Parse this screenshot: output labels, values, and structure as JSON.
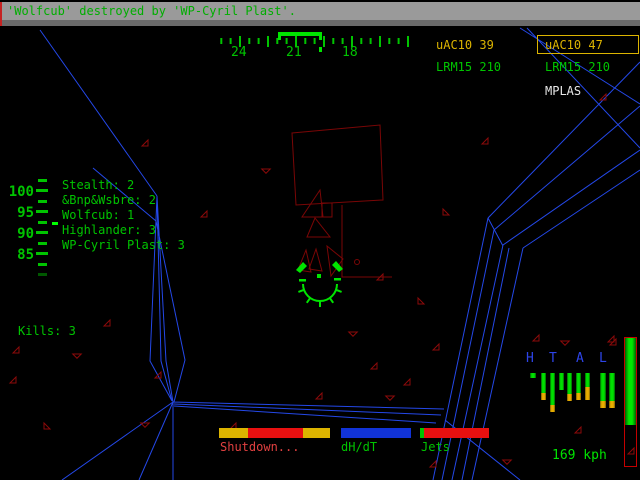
{
  "colors": {
    "hud_green": "#00c400",
    "bright_green": "#00e400",
    "hud_yellow": "#dcb400",
    "hud_red": "#e81010",
    "red_text": "#e04040",
    "hud_blue_bar": "#1133d8",
    "cockpit_blue": "#2448e8",
    "letter_blue": "#2d44e8",
    "wireframe_maroon": "#7a0606",
    "message_bar_gray": "#9a9a9a",
    "white": "#e8e8e8"
  },
  "message_bar": {
    "text": "'Wolfcub' destroyed by 'WP-Cyril Plast'."
  },
  "compass": {
    "labels": [
      "24",
      "21",
      "18"
    ]
  },
  "weapons": {
    "left": [
      {
        "label": "uAC10 39"
      },
      {
        "label": "LRM15 210"
      }
    ],
    "right": [
      {
        "label": "uAC10 47",
        "selected": true
      },
      {
        "label": "LRM15 210"
      },
      {
        "label": "MPLAS"
      }
    ]
  },
  "throttle_scale": {
    "labels": [
      "100",
      "95",
      "90",
      "85"
    ]
  },
  "scoreboard": [
    "Stealth: 2",
    "&Bnp&Wsbre: 2",
    "Wolfcub: 1",
    "Highlander: 3",
    "WP-Cyril Plast: 3"
  ],
  "kills": "Kills: 3",
  "bottom": {
    "shutdown": "Shutdown...",
    "dhdt": "dH/dT",
    "jets": "Jets"
  },
  "speed": "169 kph",
  "damage_panel": {
    "letters": [
      "H",
      "T",
      "A",
      "L"
    ],
    "bars": [
      {
        "x": 530,
        "w": 6,
        "green": 5,
        "yellow": 0
      },
      {
        "x": 541,
        "w": 5,
        "green": 20,
        "yellow": 7
      },
      {
        "x": 550,
        "w": 5,
        "green": 32,
        "yellow": 7
      },
      {
        "x": 559,
        "w": 5,
        "green": 17,
        "yellow": 0
      },
      {
        "x": 567,
        "w": 5,
        "green": 21,
        "yellow": 7
      },
      {
        "x": 576,
        "w": 5,
        "green": 20,
        "yellow": 7
      },
      {
        "x": 585,
        "w": 5,
        "green": 14,
        "yellow": 13
      },
      {
        "x": 600,
        "w": 6,
        "green": 28,
        "yellow": 7
      },
      {
        "x": 609,
        "w": 6,
        "green": 28,
        "yellow": 7
      }
    ]
  },
  "gauges": {
    "heat": {
      "x": 219,
      "y": 428,
      "h": 10,
      "segments": [
        {
          "w": 29,
          "color": "#dcb400"
        },
        {
          "w": 55,
          "color": "#e81010"
        },
        {
          "w": 27,
          "color": "#dcb400"
        }
      ]
    },
    "dhdt": {
      "x": 341,
      "y": 428,
      "h": 10,
      "segments": [
        {
          "w": 70,
          "color": "#1133d8"
        }
      ]
    },
    "jets": {
      "x": 420,
      "y": 428,
      "h": 10,
      "segments": [
        {
          "w": 4,
          "color": "#00c400"
        },
        {
          "w": 65,
          "color": "#e81010"
        }
      ]
    }
  },
  "throttle_gauge": {
    "green_height": 87
  },
  "debris": [
    [
      142,
      140,
      0
    ],
    [
      201,
      211,
      0
    ],
    [
      263,
      166,
      45
    ],
    [
      482,
      138,
      0
    ],
    [
      443,
      209,
      90
    ],
    [
      600,
      94,
      0
    ],
    [
      13,
      347,
      0
    ],
    [
      74,
      351,
      45
    ],
    [
      104,
      320,
      0
    ],
    [
      44,
      423,
      90
    ],
    [
      10,
      377,
      0
    ],
    [
      155,
      372,
      0
    ],
    [
      142,
      420,
      45
    ],
    [
      230,
      423,
      0
    ],
    [
      316,
      393,
      0
    ],
    [
      387,
      393,
      45
    ],
    [
      404,
      379,
      0
    ],
    [
      433,
      344,
      0
    ],
    [
      533,
      335,
      0
    ],
    [
      562,
      338,
      45
    ],
    [
      608,
      336,
      0
    ],
    [
      430,
      461,
      0
    ],
    [
      504,
      457,
      45
    ],
    [
      628,
      448,
      0
    ],
    [
      575,
      427,
      0
    ],
    [
      350,
      329,
      45
    ],
    [
      371,
      363,
      0
    ],
    [
      418,
      298,
      90
    ],
    [
      377,
      274,
      0
    ],
    [
      610,
      339,
      0
    ]
  ]
}
